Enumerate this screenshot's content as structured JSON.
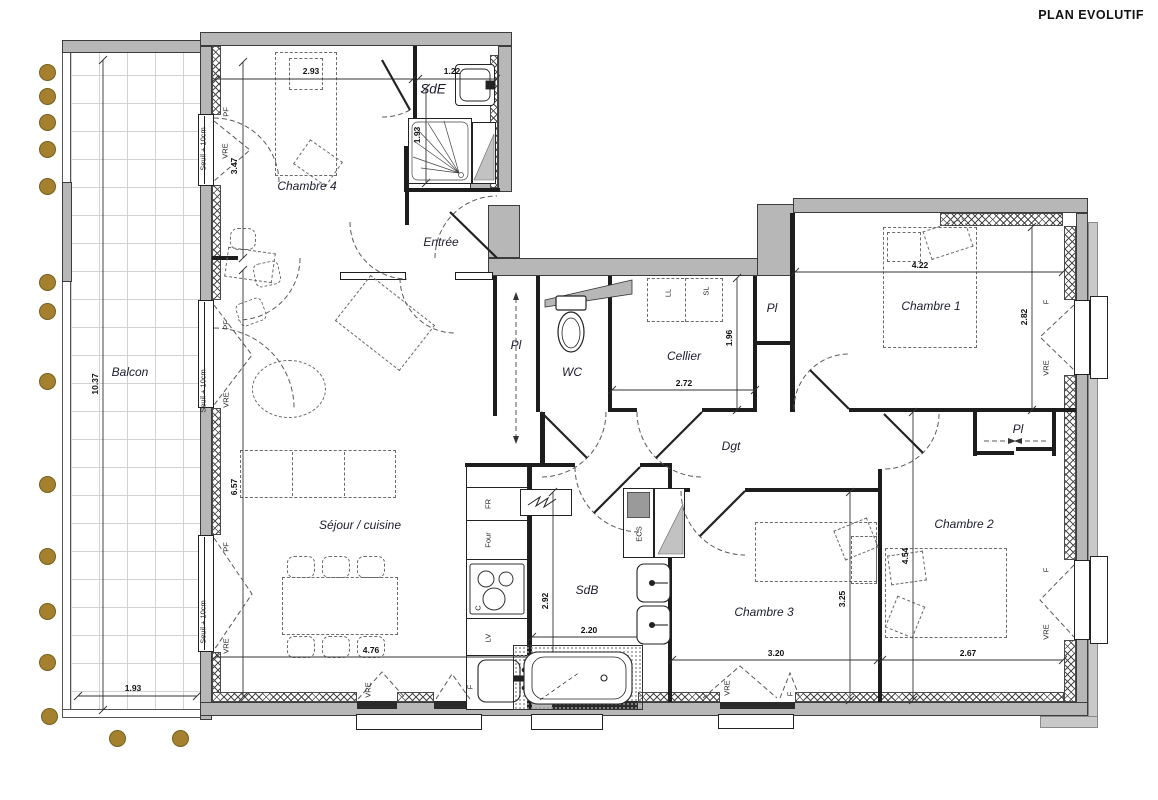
{
  "title": "PLAN EVOLUTIF",
  "rooms": {
    "balcon": "Balcon",
    "chambre4": "Chambre 4",
    "sde": "SdE",
    "entree": "Entrée",
    "sejour": "Séjour / cuisine",
    "wc": "WC",
    "cellier": "Cellier",
    "dgt": "Dgt",
    "chambre1": "Chambre 1",
    "chambre2": "Chambre 2",
    "chambre3": "Chambre 3",
    "sdb": "SdB"
  },
  "labels": {
    "pl": "Pl",
    "seuil": "Seuil + 10cm",
    "pf": "PF",
    "vre": "VRE",
    "f": "F",
    "fr": "FR",
    "four": "Four",
    "c": "C",
    "lv": "LV",
    "ecs": "ECS",
    "ll": "LL",
    "sl": "SL"
  },
  "dims": {
    "chambre4_w": "2.93",
    "chambre4_h": "3.47",
    "sde_w": "1.22",
    "sde_h": "1.93",
    "balcon_h": "10.37",
    "balcon_w": "1.93",
    "sejour_h": "6.57",
    "sejour_w": "4.76",
    "cellier_w": "2.72",
    "cellier_h": "1.96",
    "chambre1_w": "4.22",
    "chambre1_h": "2.82",
    "sdb_w": "2.20",
    "sdb_h": "2.92",
    "chambre3_w": "3.20",
    "chambre3_h": "3.25",
    "chambre2_w": "2.67",
    "chambre2_h": "4.54"
  },
  "colors": {
    "wall_gray": "#b7b7b7",
    "outer_gray": "#c9c9c9",
    "line_black": "#1d1d1d",
    "post_gold": "#a5812f"
  }
}
